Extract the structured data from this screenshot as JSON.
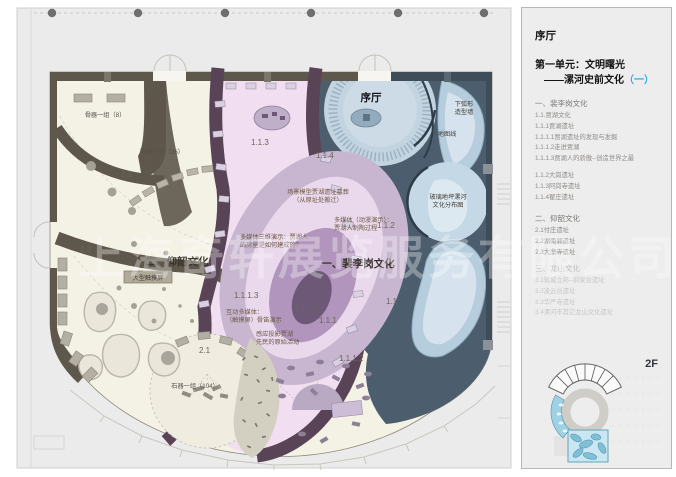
{
  "watermark": "上海奇轩展览服务有限公司",
  "colors": {
    "accent_blue": "#29abe2",
    "wall_brown": "#5e574b",
    "wall_purple": "#594457",
    "slate_area": "#4c5e6d",
    "cream_area": "#f4f1e5",
    "pink_area": "#f1dff1",
    "blue_shape": "#b6cddd"
  },
  "panel": {
    "hall": "序厅",
    "unit1": "第一单元：文明曙光",
    "unit2": "——漯河史前文化",
    "unit2_num": "（一）",
    "s1h": "一、裴李岗文化",
    "s1_items": [
      "1.1.贾湖文化",
      "1.1.1贾湖遗址",
      "1.1.1.1贾湖遗址的发现与发掘",
      "1.1.1.2走进贾湖",
      "1.1.1.3贾湖人的骄傲--创造世界之最"
    ],
    "s1b_items": [
      "1.1.2大岗遗址",
      "1.1.3阿岗寺遗址",
      "1.1.4翟庄遗址"
    ],
    "s2h": "二、仰韶文化",
    "s2_items": [
      "2.1付庄遗址",
      "2.2湖南郭遗址",
      "2.3大悲寺遗址"
    ],
    "s3h": "三、龙山文化",
    "s3_items": [
      "3.1筑城立邦--郝家台遗址",
      "3.2凌云台遗址",
      "3.3华严寺遗址",
      "3.4漯河市其它龙山文化遗址"
    ],
    "floor": "2F"
  },
  "plan": {
    "labels": {
      "yangshao_title": "二、仰韶文化",
      "peiligang_title": "一、裴李岗文化",
      "xuting": "序厅",
      "bone_group": "骨器一组（8）",
      "pottery_group": "陶器一组（26）",
      "stone_group": "石器一组（104）",
      "touchscreen": "大型触摸屏",
      "scene_model_1": "场景模型贾湖遗址墓葬",
      "scene_model_2": "（从原址处搬迁）",
      "mm_anim_1": "多媒体（动漫演示）：",
      "mm_anim_2": "贾湖人制陶过程",
      "mm_3d_1": "多媒体三维演示：贾湖人",
      "mm_3d_2": "的房屋是如何建成的？",
      "interactive_1": "互动多媒体：",
      "interactive_2": "（触摸屏）骨笛演示",
      "projection_1": "感应投影贾湖",
      "projection_2": "先民的原始活动",
      "arc_wall_1": "下弧形",
      "arc_wall_2": "造型墙",
      "map_line": "地图线",
      "glass_floor_1": "玻璃地坪漯河",
      "glass_floor_2": "文化分布图",
      "n23": "2.3",
      "n22": "2.2",
      "n21": "2.1",
      "n113": "1.1.3",
      "n114": "1.1.4",
      "n112": "1.1.2",
      "n1113": "1.1.1.3",
      "n1111": "1.1.1.1",
      "n111": "1.1.1",
      "n11": "1.1",
      "n1112": "1.1.1.2"
    }
  }
}
